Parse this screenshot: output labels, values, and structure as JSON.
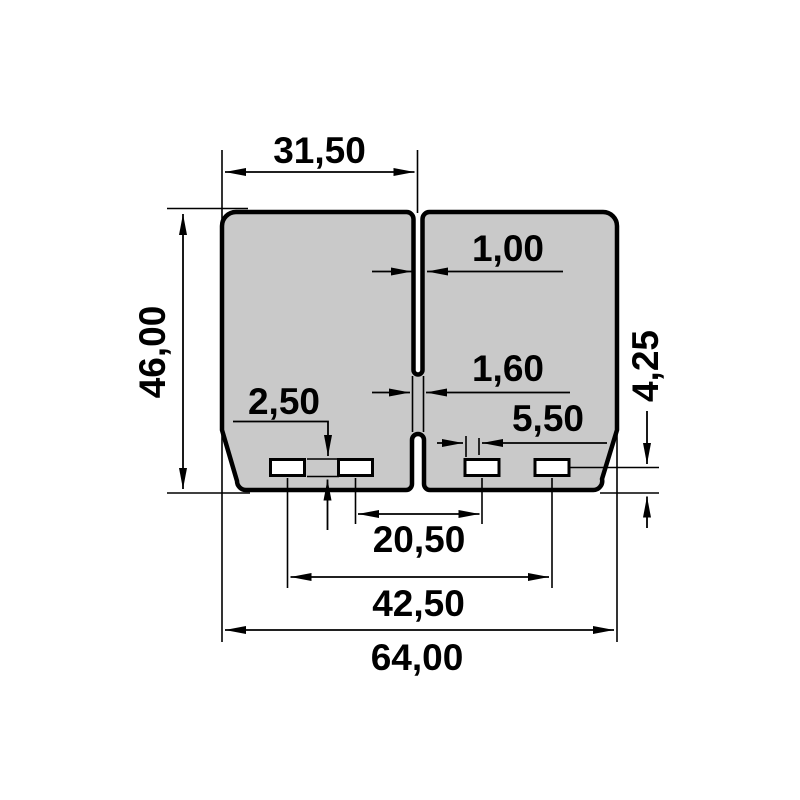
{
  "colors": {
    "part_fill": "#c9c9c9",
    "line": "#000000",
    "background": "#ffffff"
  },
  "dimensions": {
    "petal_width": "31,50",
    "overall_height": "46,00",
    "center_slit_width": "1,00",
    "lower_slit_width": "1,60",
    "slot_height": "2,50",
    "slot_width": "5,50",
    "slot_center_to_bottom": "4,25",
    "inner_slot_spacing": "20,50",
    "outer_slot_spacing": "42,50",
    "overall_width": "64,00"
  }
}
